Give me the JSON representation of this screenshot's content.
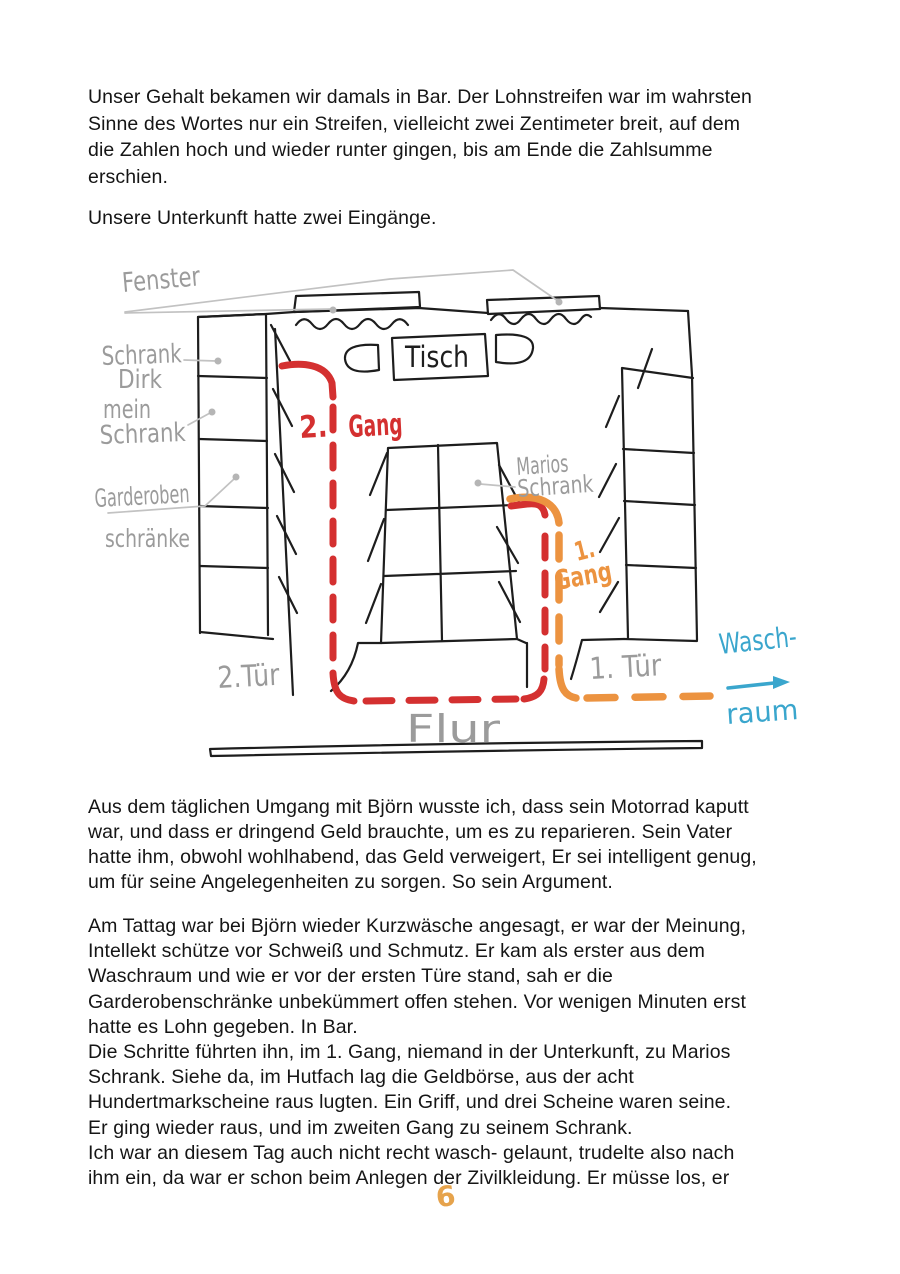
{
  "page": {
    "paragraphs": [
      "Unser Gehalt bekamen wir damals in Bar. Der Lohnstreifen war im wahrsten\nSinne des Wortes nur ein Streifen, vielleicht zwei Zentimeter breit, auf dem\ndie Zahlen hoch und wieder runter gingen, bis am Ende die Zahlsumme\nerschien.",
      "Unsere Unterkunft hatte zwei Eingänge.",
      "Aus dem täglichen Umgang mit Björn wusste ich, dass sein Motorrad kaputt\nwar, und dass er dringend Geld brauchte, um es zu reparieren. Sein Vater\nhatte ihm, obwohl wohlhabend, das Geld verweigert, Er sei intelligent genug,\num für seine Angelegenheiten zu sorgen. So sein Argument.",
      "Am Tattag war bei Björn wieder Kurzwäsche angesagt, er war der Meinung,\nIntellekt schütze vor Schweiß und Schmutz. Er kam als erster aus dem\nWaschraum und wie er vor der ersten Türe stand, sah er die\nGarderobenschränke unbekümmert offen stehen. Vor wenigen Minuten erst\nhatte es Lohn gegeben. In Bar.\nDie Schritte führten ihn, im 1. Gang, niemand in der Unterkunft, zu Marios\nSchrank. Siehe da, im Hutfach lag die Geldbörse, aus der acht\nHundertmarkscheine raus lugten. Ein Griff, und drei Scheine waren seine.\nEr ging wieder raus, und im zweiten Gang zu seinem Schrank.\nIch war an diesem Tag auch nicht recht wasch- gelaunt, trudelte also nach\nihm ein, da war er schon beim Anlegen der Zivilkleidung. Er müsse los, er"
    ],
    "page_number": "6"
  },
  "diagram": {
    "labels": {
      "fenster": "Fenster",
      "schrank_dirk_1": "Schrank",
      "schrank_dirk_2": "Dirk",
      "mein_schrank_1": "mein",
      "mein_schrank_2": "Schrank",
      "garderoben_1": "Garderoben",
      "garderoben_2": "schränke",
      "tisch": "Tisch",
      "marios_1": "Marios",
      "marios_2": "Schrank",
      "gang2_num": "2.",
      "gang2_word": "Gang",
      "gang1_num": "1.",
      "gang1_word": "Gang",
      "tuer2": "2.Tür",
      "tuer1": "1. Tür",
      "flur": "Flur",
      "wasch_1": "Wasch-",
      "wasch_2": "raum"
    },
    "colors": {
      "route2_red": "#d43030",
      "route1_orange": "#ec9340",
      "waschraum_cyan": "#3aa6cd",
      "handwriting_gray": "#9b9b9b",
      "ink": "#1d1d1d",
      "page_number_orange": "#e6a34c"
    }
  }
}
